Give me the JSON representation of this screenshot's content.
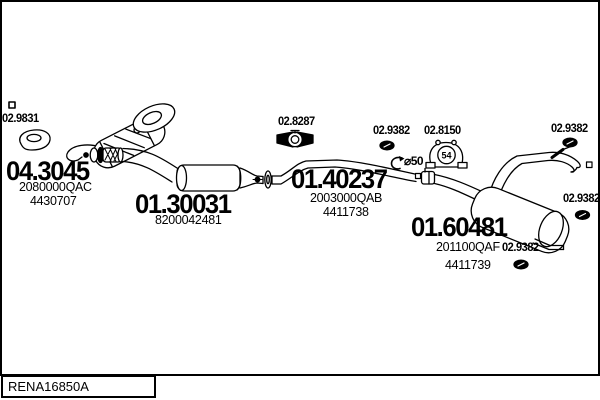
{
  "diagram": {
    "drawing_number": "RENA16850A",
    "background": "#ffffff",
    "line_color": "#000000",
    "annotations": {
      "pipe_diameter": "⌀50",
      "hanger_number": "54"
    },
    "parts": {
      "front_gasket": {
        "code": "02.9831",
        "icon": "gasket-icon"
      },
      "catalyst": {
        "code": "04.3045",
        "oem": "2080000QAC",
        "ref": "4430707"
      },
      "centre_muffler": {
        "code": "01.30031",
        "oem": "8200042481"
      },
      "front_clamp": {
        "code": "02.8287",
        "icon": "u-bolt-clamp-icon"
      },
      "centre_pipe": {
        "code": "01.40237",
        "oem": "2003000QAB",
        "ref": "4411738"
      },
      "clamp_a": {
        "code": "02.9382",
        "icon": "clamp-icon"
      },
      "hanger": {
        "code": "02.8150",
        "icon": "rubber-hanger-icon"
      },
      "clamp_b": {
        "code": "02.9382",
        "icon": "clamp-icon"
      },
      "clamp_c": {
        "code": "02.9382",
        "icon": "clamp-icon"
      },
      "rear_muffler": {
        "code": "01.60481",
        "oem": "201100QAF",
        "ref": "4411739"
      },
      "clamp_d": {
        "code": "02.9382",
        "icon": "clamp-icon"
      }
    }
  }
}
